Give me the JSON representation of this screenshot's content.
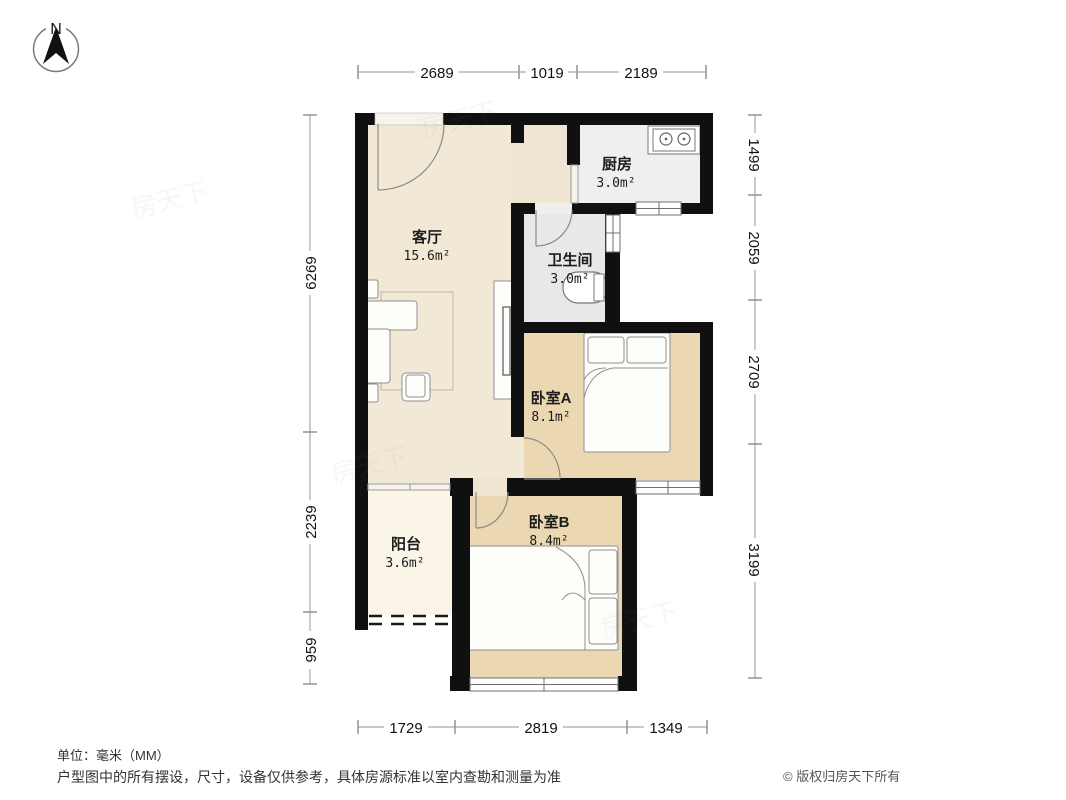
{
  "compass": {
    "label": "N"
  },
  "rooms": {
    "living": {
      "name": "客厅",
      "area": "15.6m²"
    },
    "kitchen": {
      "name": "厨房",
      "area": "3.0m²"
    },
    "bathroom": {
      "name": "卫生间",
      "area": "3.0m²"
    },
    "bedroomA": {
      "name": "卧室A",
      "area": "8.1m²"
    },
    "bedroomB": {
      "name": "卧室B",
      "area": "8.4m²"
    },
    "balcony": {
      "name": "阳台",
      "area": "3.6m²"
    }
  },
  "dimensions": {
    "top": [
      "2689",
      "1019",
      "2189"
    ],
    "bottom": [
      "1729",
      "2819",
      "1349"
    ],
    "left": [
      "6269",
      "2239",
      "959"
    ],
    "right": [
      "1499",
      "2059",
      "2709",
      "3199"
    ]
  },
  "footer": {
    "unit_note": "单位：毫米（MM）",
    "disclaimer": "户型图中的所有摆设，尺寸，设备仅供参考，具体房源标准以室内查勘和测量为准",
    "copyright": "© 版权归房天下所有"
  },
  "watermark": "房天下",
  "colors": {
    "wall": "#101010",
    "living": "#f2e8d6",
    "bedroom": "#ebd7b1",
    "kitchen": "#eef0ef",
    "bathroom": "#e8e8ea",
    "balcony": "#faf5e8"
  }
}
